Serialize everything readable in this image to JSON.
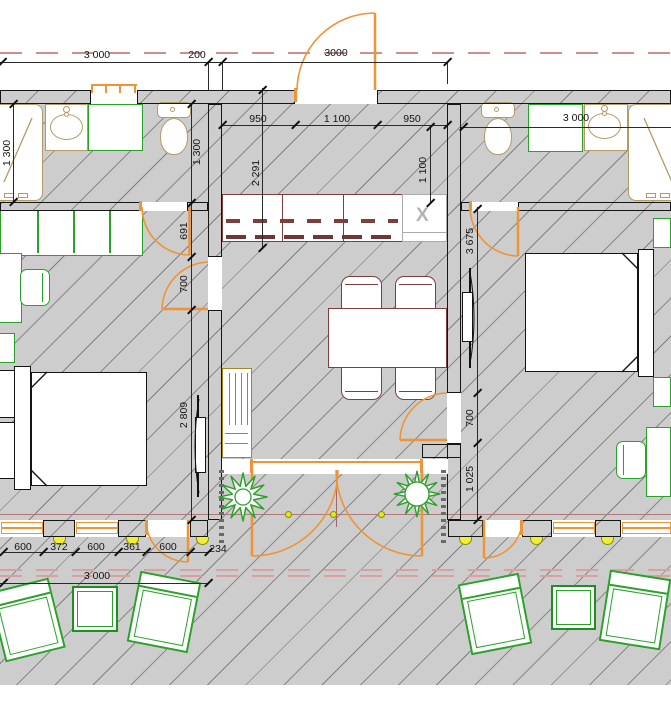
{
  "drawing": {
    "kind": "architectural floor plan, twin hotel suites with shared living room and terrace",
    "units": "mm"
  },
  "palette": {
    "door_accent": "#ef9434",
    "furniture_green": "#2aa22a",
    "kitchen_maroon": "#7e3e3e",
    "fixture_tan": "#b49a68",
    "axis_rose": "#cf8f8f",
    "floor_gray": "#cdcdcd",
    "marker_yellow": "#f0ee35"
  },
  "symbols": {
    "cooktop": "X"
  },
  "dims": {
    "top": [
      "3 000",
      "200",
      "3000"
    ],
    "kitchen_top": [
      "950",
      "1 100",
      "950"
    ],
    "kitchen_depth": "1 100",
    "hall_depth": "2 291",
    "bath_left_a": "1 300",
    "bath_left_b": "1 300",
    "left_chain": [
      "691",
      "700",
      "2 809"
    ],
    "bath_right": "3 000",
    "right_chain": [
      "3 675",
      "700",
      "1 025"
    ],
    "bottom_chain": [
      "600",
      "372",
      "600",
      "361",
      "600",
      "234"
    ],
    "terrace": "3 000"
  }
}
